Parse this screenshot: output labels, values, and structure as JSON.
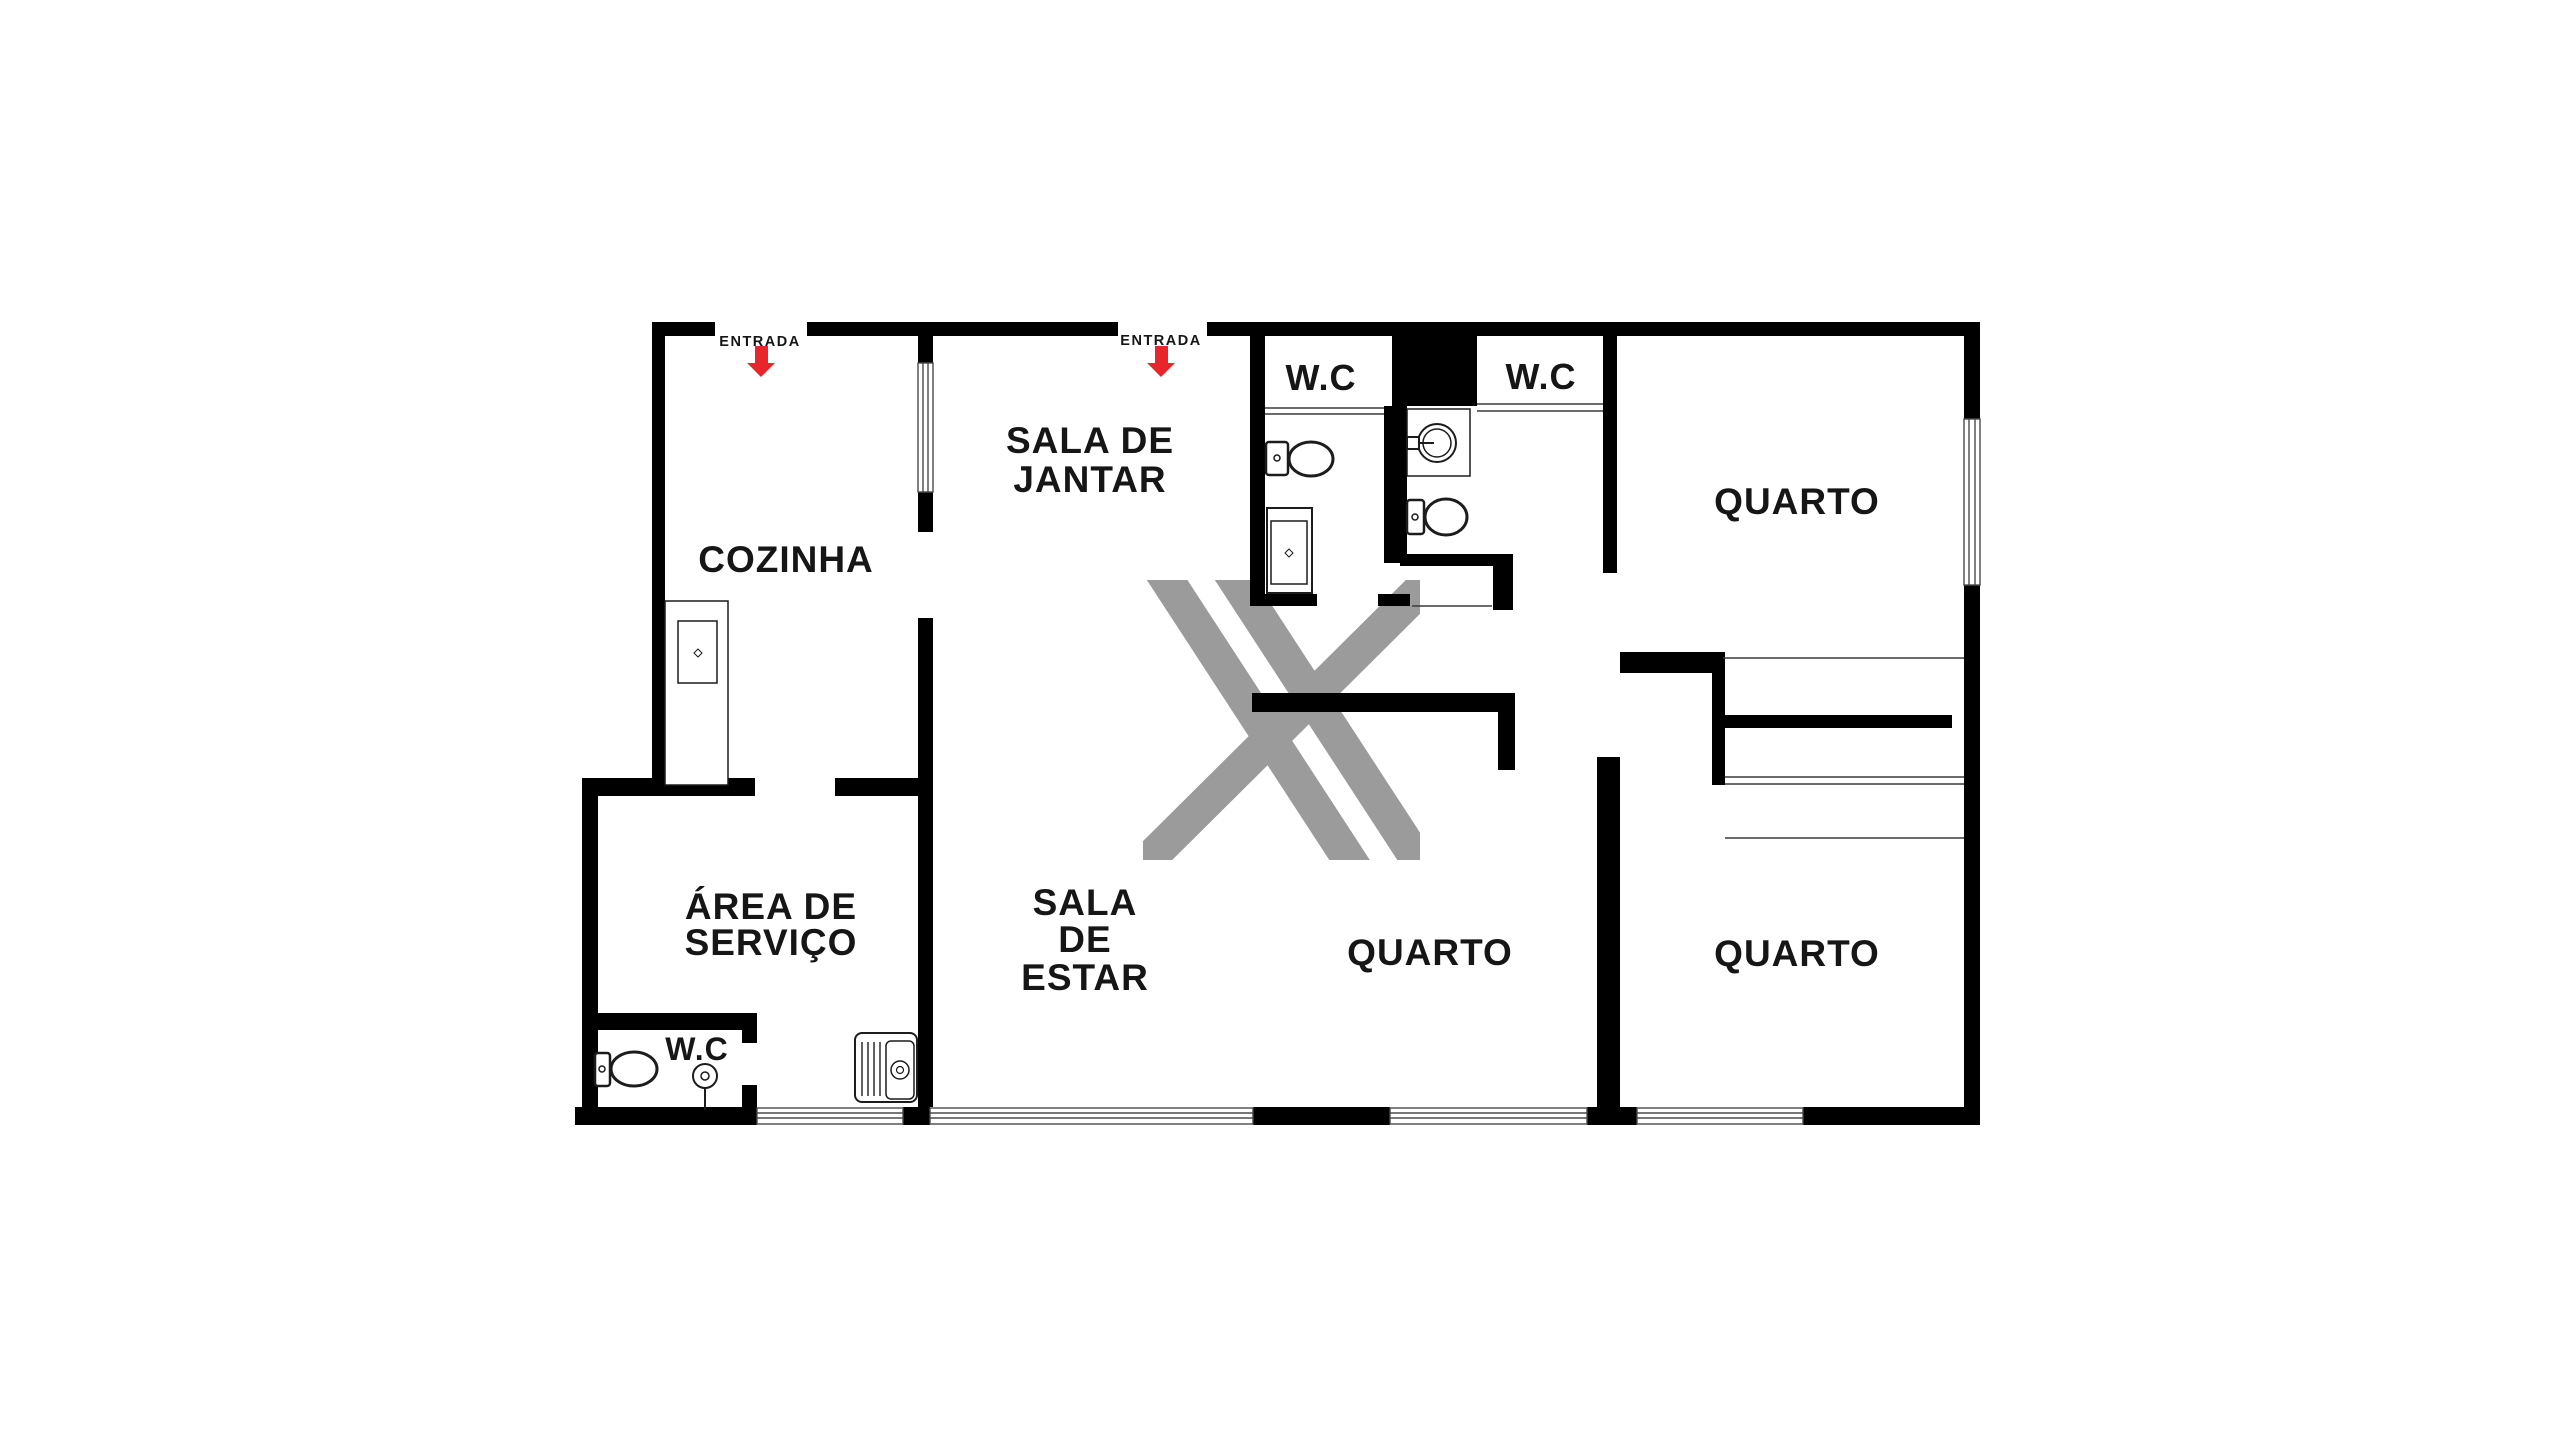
{
  "document": {
    "type": "apartment floor plan",
    "background": "#ffffff"
  },
  "colors": {
    "wall": "#000000",
    "accent_red": "#e8252b",
    "watermark_gray": "#9b9b9b",
    "text": "#161616"
  },
  "rooms": {
    "cozinha": {
      "label": "COZINHA"
    },
    "sala_jantar": {
      "line1": "SALA DE",
      "line2": "JANTAR"
    },
    "sala_estar": {
      "line1": "SALA",
      "line2": "DE",
      "line3": "ESTAR"
    },
    "area_servico": {
      "line1": "ÁREA DE",
      "line2": "SERVIÇO"
    },
    "wc_left": {
      "label": "W.C"
    },
    "wc_right": {
      "label": "W.C"
    },
    "wc_servico": {
      "label": "W.C"
    },
    "quarto_top": {
      "label": "QUARTO"
    },
    "quarto_mid": {
      "label": "QUARTO"
    },
    "quarto_right": {
      "label": "QUARTO"
    }
  },
  "entrances": {
    "cozinha": {
      "label": "ENTRADA"
    },
    "sala_jantar": {
      "label": "ENTRADA"
    }
  },
  "icons": {
    "toilet": "toilet-icon",
    "sink_round": "round-sink-icon",
    "kitchen_sink": "kitchen-sink-icon",
    "vanity": "vanity-icon",
    "shower": "shower-icon",
    "stove": "stove-icon",
    "arrow_down": "entrance-arrow-down-icon",
    "watermark": "x-watermark"
  }
}
